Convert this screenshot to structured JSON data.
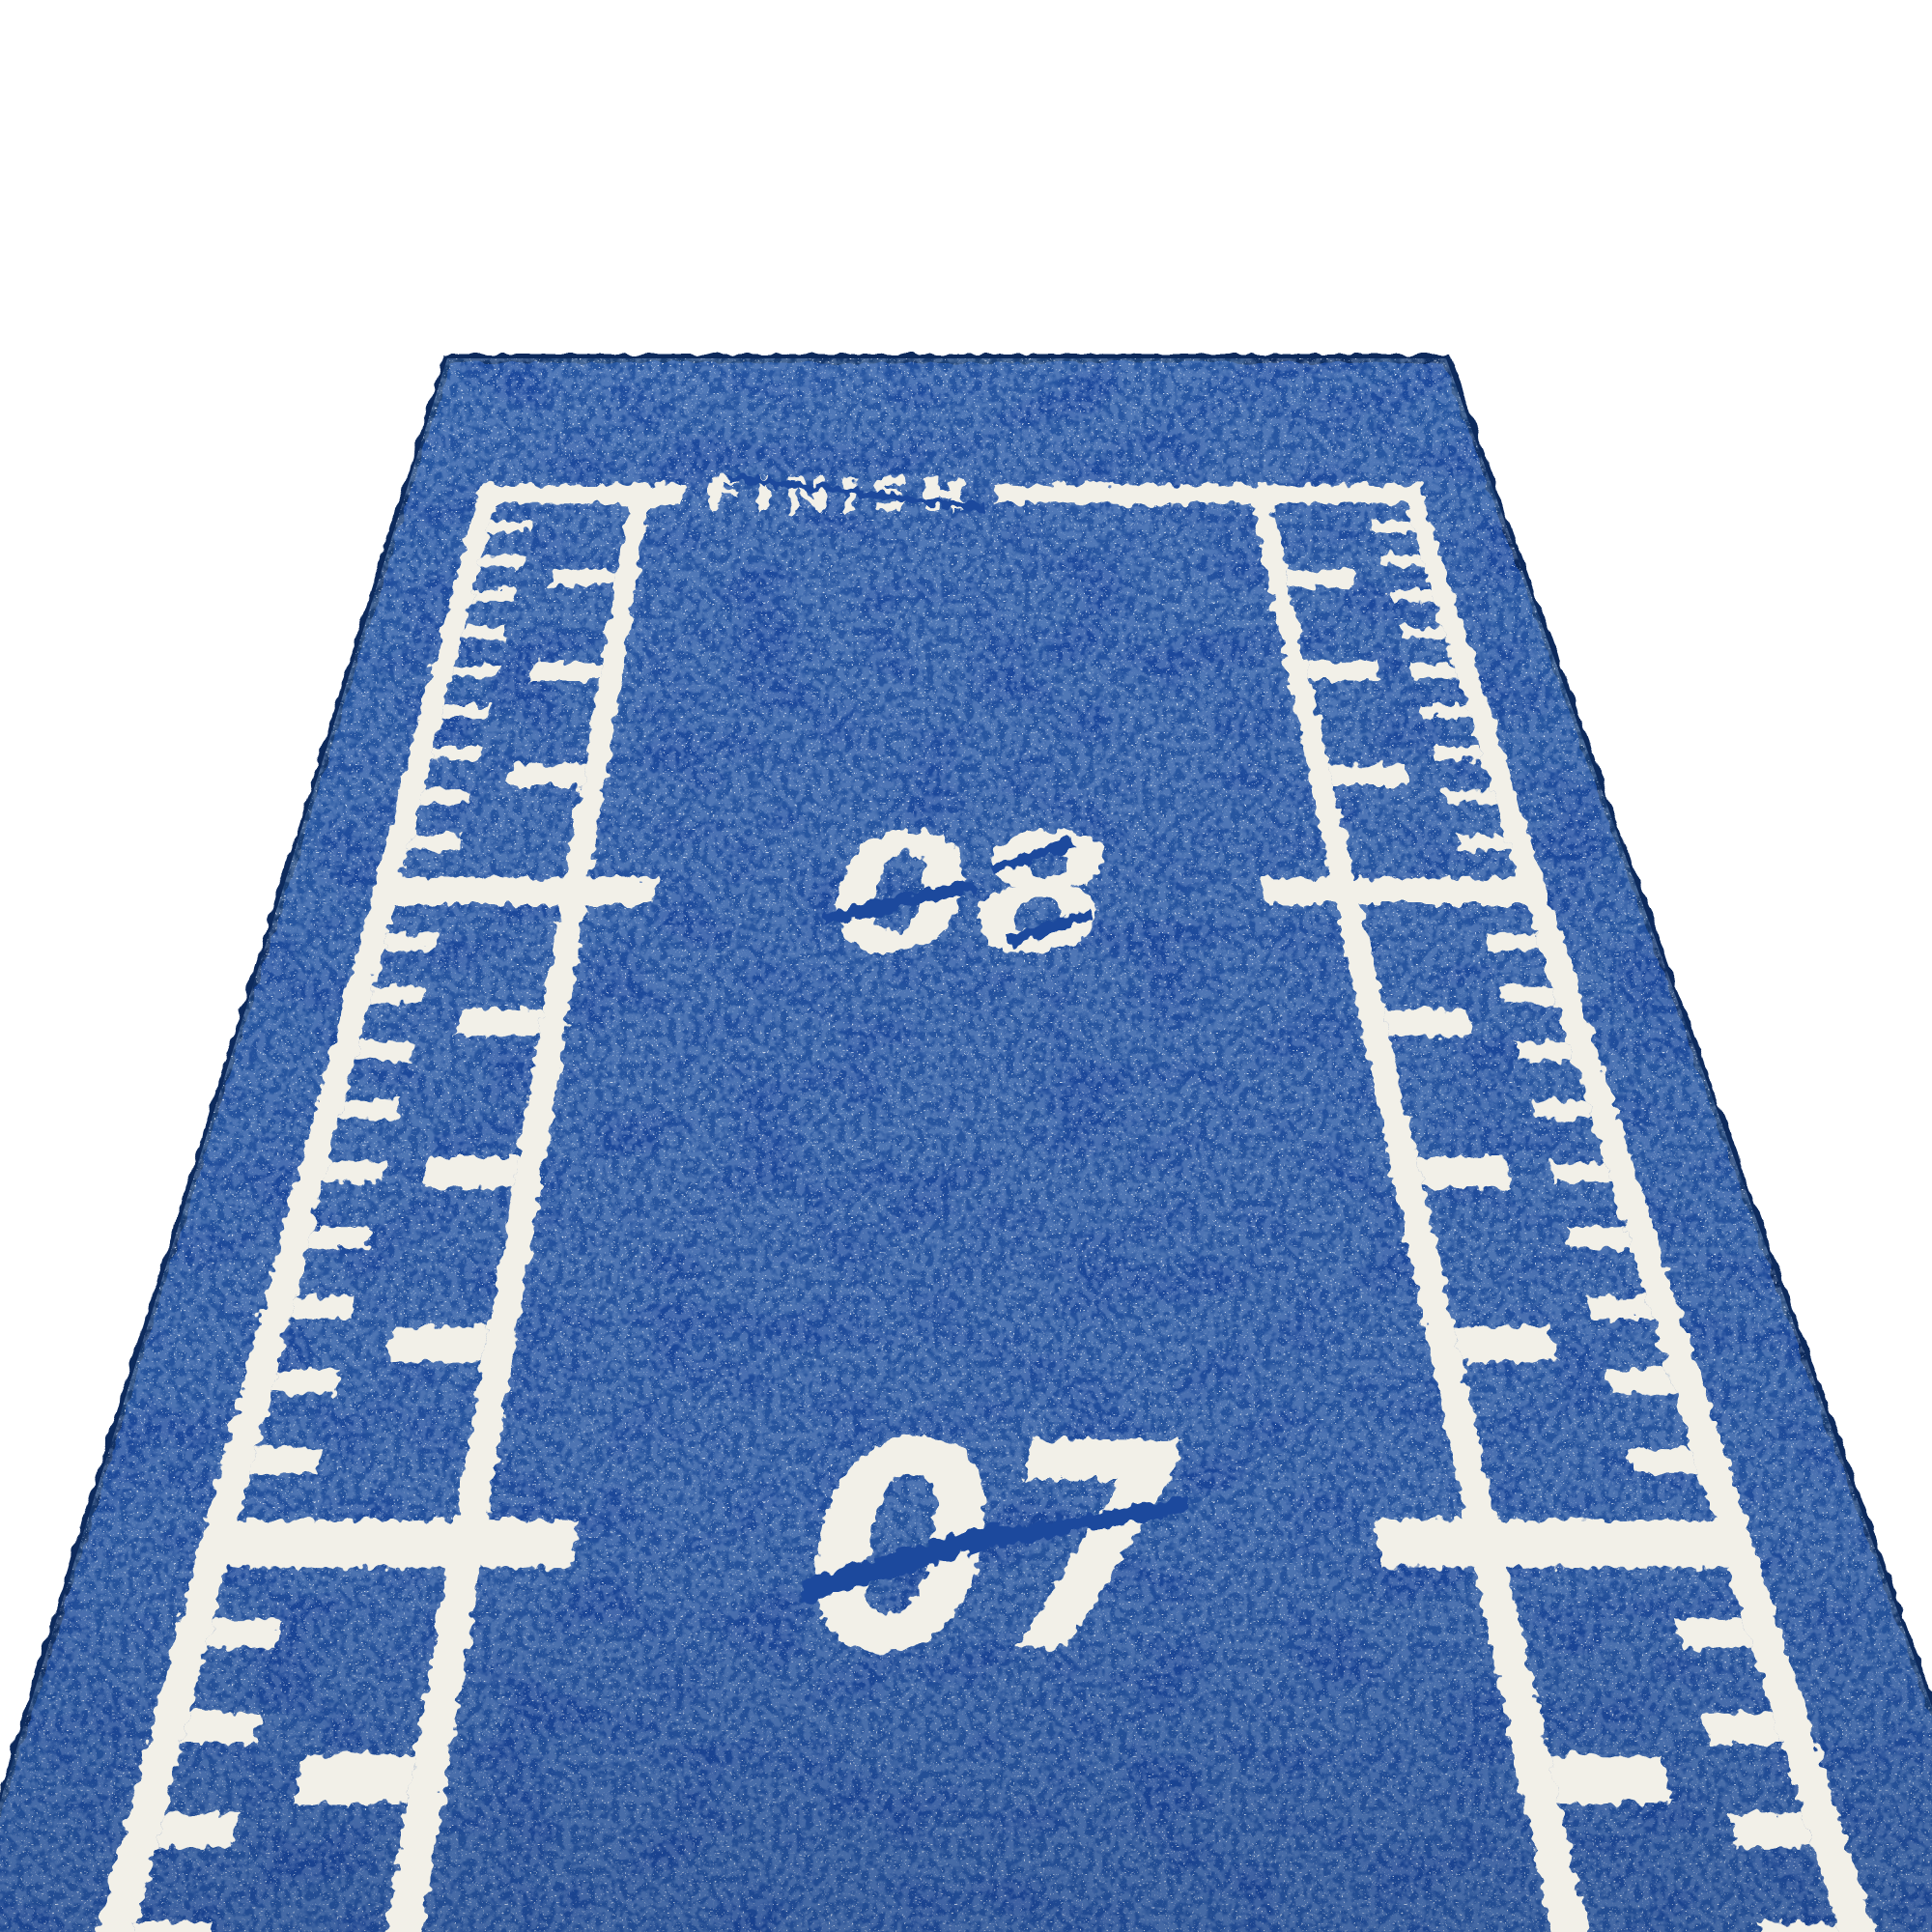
{
  "scene": {
    "background_color": "#ffffff",
    "mat": {
      "turf_color": "#1d4a9d",
      "turf_dark_color": "#0e2c66",
      "turf_light_color": "#7fa3e0",
      "speckle_color": "#eef3fc",
      "paint_color": "#f2f0e8",
      "edge_color": "#10295c"
    },
    "finish": {
      "label": "FINISH",
      "at_meters": 9
    },
    "markers": [
      {
        "label": "08",
        "meters": 8
      },
      {
        "label": "07",
        "meters": 7
      }
    ],
    "ruler": {
      "minor_step_m": 0.1,
      "medium_step_m": 0.25,
      "major_step_m": 1,
      "visible_min_m": 6.55,
      "visible_max_m": 9
    }
  }
}
